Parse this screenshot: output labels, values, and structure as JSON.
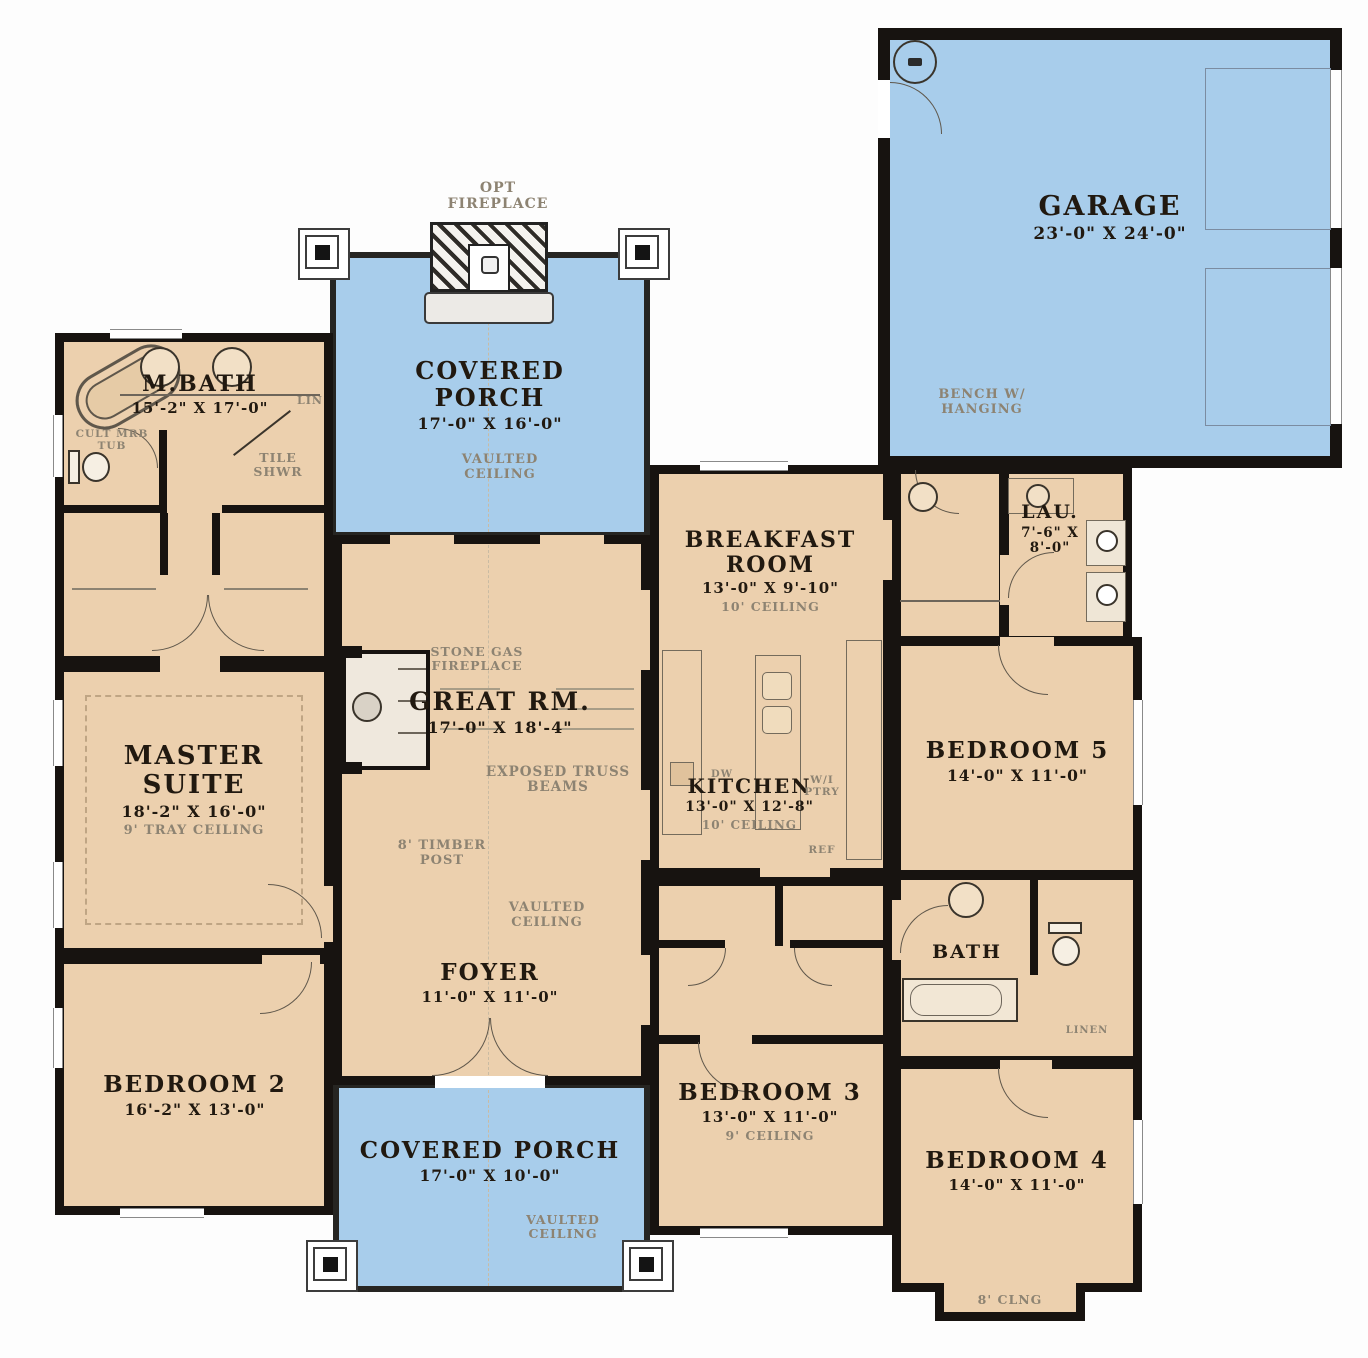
{
  "colors": {
    "room_fill": "#ecd0ae",
    "porch_fill": "#a8cdeb",
    "wall": "#171310",
    "note": "#8d8372"
  },
  "rooms": {
    "garage": {
      "name": "GARAGE",
      "dims": "23'-0\" X 24'-0\"",
      "note": "BENCH W/ HANGING"
    },
    "porch_top": {
      "name": "COVERED PORCH",
      "dims": "17'-0\" X 16'-0\"",
      "ceiling": "VAULTED CEILING",
      "fireplace": "OPT FIREPLACE"
    },
    "mbath": {
      "name": "M.BATH",
      "dims": "15'-2\" X 17'-0\"",
      "tub": "CULT MRB TUB",
      "shower": "TILE SHWR",
      "linen": "LIN"
    },
    "master": {
      "name": "MASTER SUITE",
      "dims": "18'-2\" X 16'-0\"",
      "ceiling": "9' TRAY CEILING"
    },
    "great": {
      "name": "GREAT RM.",
      "dims": "17'-0\" X 18'-4\"",
      "fireplace": "STONE GAS FIREPLACE",
      "truss": "EXPOSED TRUSS BEAMS",
      "post": "8' TIMBER POST",
      "ceiling": "VAULTED CEILING"
    },
    "breakfast": {
      "name": "BREAKFAST ROOM",
      "dims": "13'-0\" X 9'-10\"",
      "ceiling": "10' CEILING"
    },
    "kitchen": {
      "name": "KITCHEN",
      "dims": "13'-0\" X 12'-8\"",
      "ceiling": "10' CEILING",
      "pantry": "W/I PTRY",
      "ref": "REF",
      "dw": "DW"
    },
    "laundry": {
      "name": "LAU.",
      "dims": "7'-6\" X 8'-0\""
    },
    "bedroom5": {
      "name": "BEDROOM 5",
      "dims": "14'-0\" X 11'-0\""
    },
    "bath": {
      "name": "BATH",
      "linen": "LINEN"
    },
    "foyer": {
      "name": "FOYER",
      "dims": "11'-0\" X 11'-0\"",
      "ceiling": "VAULTED CEILING"
    },
    "bedroom2": {
      "name": "BEDROOM 2",
      "dims": "16'-2\" X 13'-0\""
    },
    "bedroom3": {
      "name": "BEDROOM 3",
      "dims": "13'-0\" X 11'-0\"",
      "ceiling": "9' CEILING"
    },
    "bedroom4": {
      "name": "BEDROOM 4",
      "dims": "14'-0\" X 11'-0\"",
      "ceiling": "8' CLNG"
    },
    "porch_bottom": {
      "name": "COVERED PORCH",
      "dims": "17'-0\" X 10'-0\"",
      "ceiling": "VAULTED CEILING"
    }
  }
}
